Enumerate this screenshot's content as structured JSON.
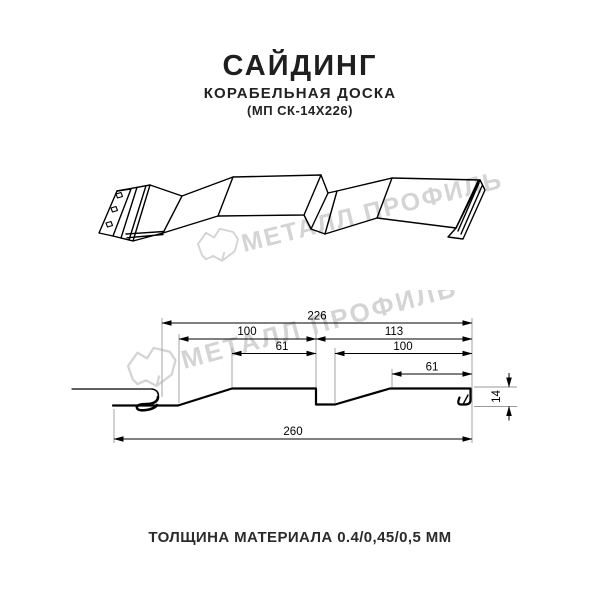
{
  "header": {
    "title": "САЙДИНГ",
    "subtitle": "КОРАБЕЛЬНАЯ ДОСКА",
    "model_code": "(МП СК-14Х226)"
  },
  "footer": {
    "thickness_note": "ТОЛЩИНА МАТЕРИАЛА 0.4/0,45/0,5 ММ"
  },
  "watermark": {
    "brand": "МЕТАЛЛ ПРОФИЛЬ",
    "color": "#d4d4d4"
  },
  "cross_section": {
    "dim_module_width": "226",
    "dim_left_pan": "100",
    "dim_left_flat": "61",
    "dim_right_module": "113",
    "dim_right_pan": "100",
    "dim_right_flat": "61",
    "dim_overall_width": "260",
    "dim_height": "14"
  }
}
